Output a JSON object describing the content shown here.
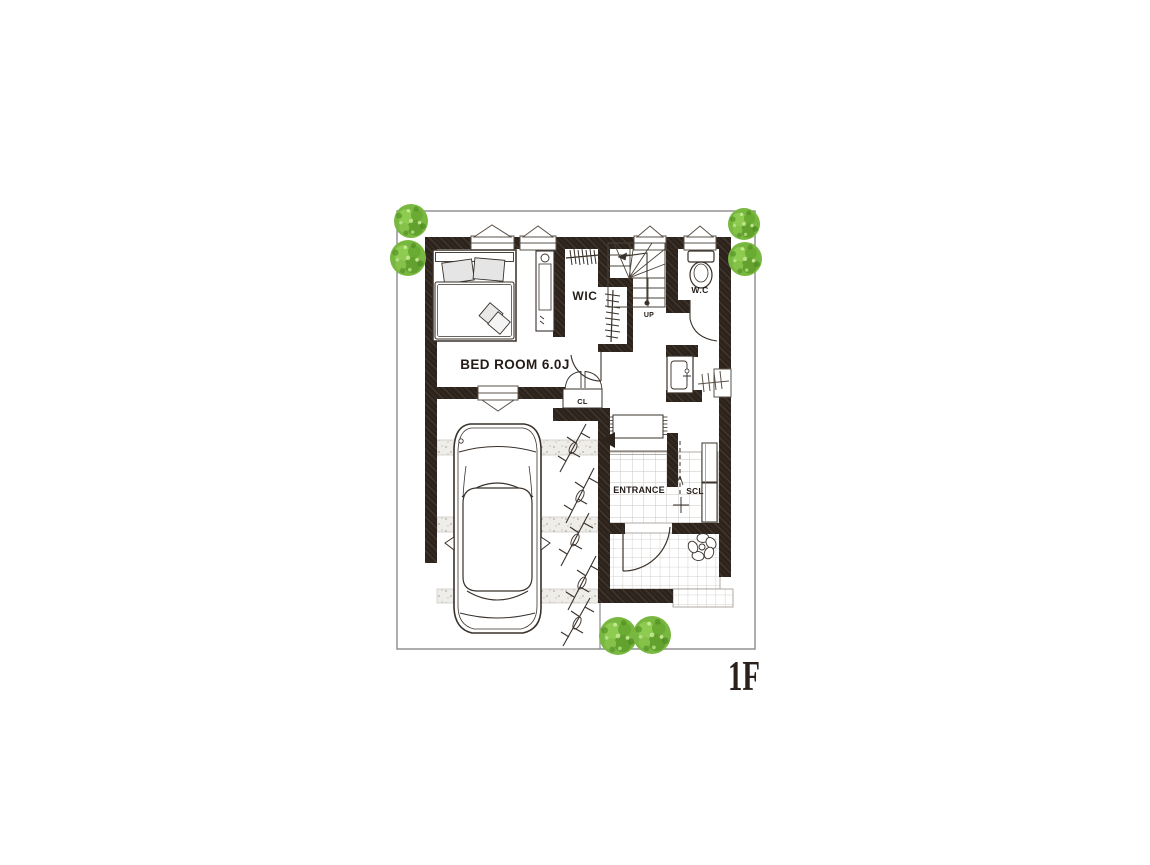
{
  "plan": {
    "floor_label": "1F",
    "labels": {
      "bedroom": "BED ROOM 6.0J",
      "wic": "WIC",
      "wc": "W.C",
      "closet": "CL",
      "entrance": "ENTRANCE",
      "shoe_closet": "SCL",
      "stairs_up": "UP"
    },
    "colors": {
      "wall": "#2c231d",
      "wall_hatch_highlight": "#55483a",
      "line": "#3a322b",
      "tile_line": "#c9c5bf",
      "tree_green": "#79b840",
      "tree_green_dark": "#5f9e2c",
      "tree_green_light": "#a6d96a",
      "pillow_gray": "#e5e5e5",
      "paper": "#ffffff",
      "boundary_gray": "#8a8a8a"
    }
  }
}
